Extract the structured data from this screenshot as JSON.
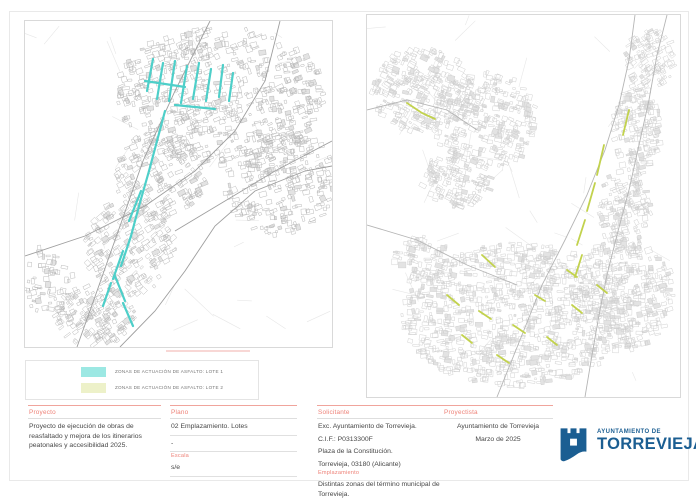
{
  "legend": {
    "items": [
      {
        "label": "ZONAS DE ACTUACIÓN DE ASFALTO: LOTE 1",
        "swatch": "#9ce8e3"
      },
      {
        "label": "ZONAS DE ACTUACIÓN DE ASFALTO: LOTE 2",
        "swatch": "#edf1c9"
      }
    ]
  },
  "titleblock": {
    "proyecto_label": "Proyecto",
    "proyecto_value": "Proyecto de ejecución de obras de reasfaltado y mejora de los itinerarios peatonales y accesibilidad 2025.",
    "plano_label": "Plano",
    "plano_value": "02 Emplazamiento. Lotes",
    "plano_extra": "-",
    "escala_label": "Escala",
    "escala_value": "s/e",
    "solicitante_label": "Solicitante",
    "solicitante_lines": [
      "Exc. Ayuntamiento de Torrevieja.",
      "C.I.F.: P0313300F",
      "Plaza de la Constitución.",
      "Torrevieja, 03180 (Alicante)"
    ],
    "emplazamiento_label": "Emplazamiento",
    "emplazamiento_value": "Distintas zonas del término municipal de Torrevieja.",
    "proyectista_label": "Proyectista",
    "proyectista_line1": "Ayuntamiento de Torrevieja",
    "proyectista_line2": "Marzo de 2025"
  },
  "logo": {
    "icon": "castle-icon",
    "line1": "AYUNTAMIENTO DE",
    "line2": "TORREVIEJA",
    "color": "#1b5e92"
  },
  "colors": {
    "label_accent": "#ee8278",
    "lote1_highlight": "#4ecfc9",
    "lote2_highlight": "#c2d24d",
    "map_left_stroke": "#b8b8b8",
    "map_right_stroke": "#cfcfcf"
  }
}
